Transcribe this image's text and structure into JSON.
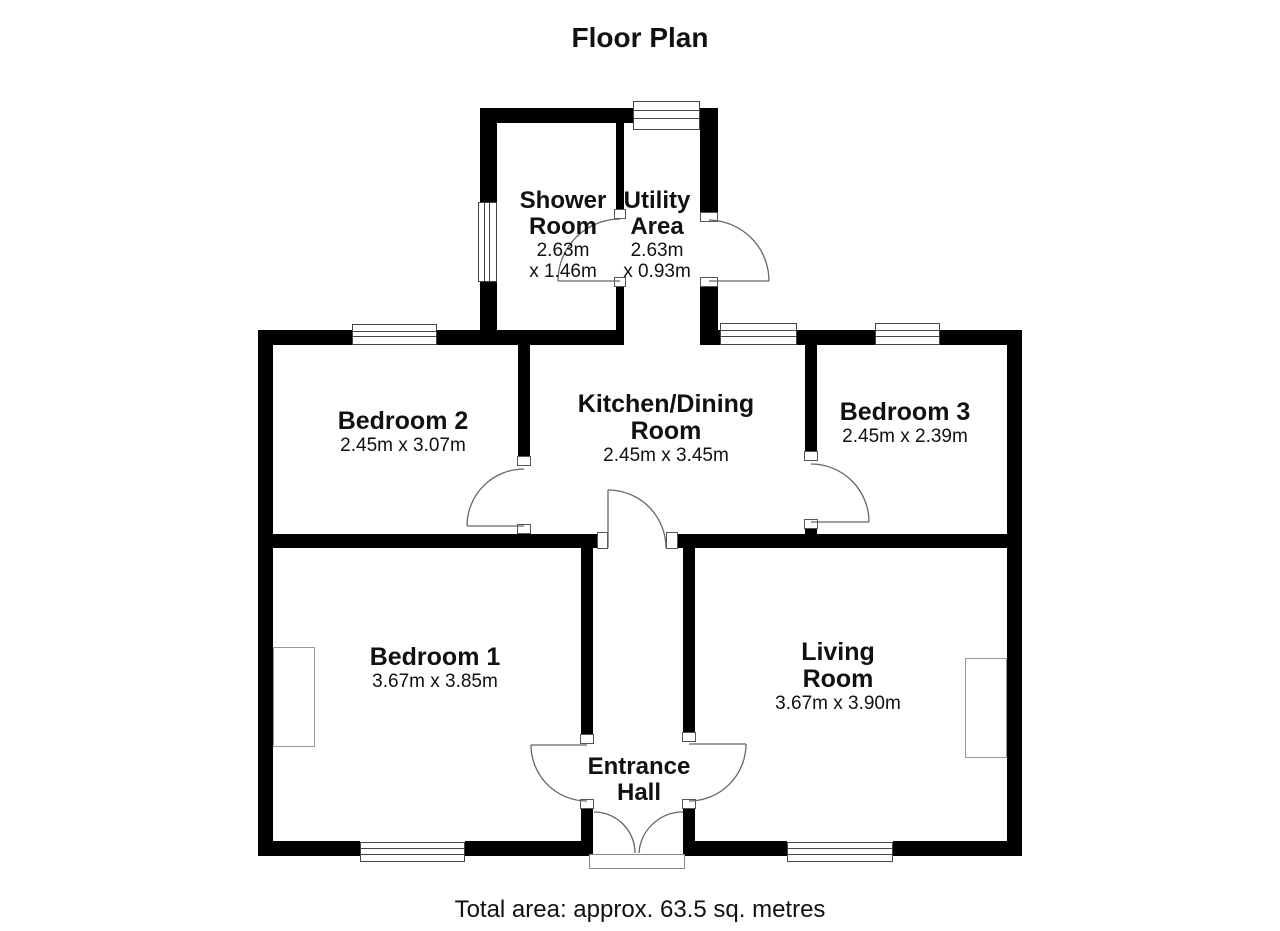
{
  "title": "Floor Plan",
  "footer": "Total area: approx. 63.5 sq. metres",
  "rooms": {
    "shower": {
      "name1": "Shower",
      "name2": "Room",
      "dim1": "2.63m",
      "dim2": "x 1.46m"
    },
    "utility": {
      "name1": "Utility",
      "name2": "Area",
      "dim1": "2.63m",
      "dim2": "x 0.93m"
    },
    "bedroom2": {
      "name1": "Bedroom 2",
      "dim1": "2.45m x 3.07m"
    },
    "kitchen": {
      "name1": "Kitchen/Dining",
      "name2": "Room",
      "dim1": "2.45m x 3.45m"
    },
    "bedroom3": {
      "name1": "Bedroom 3",
      "dim1": "2.45m x 2.39m"
    },
    "bedroom1": {
      "name1": "Bedroom 1",
      "dim1": "3.67m x 3.85m"
    },
    "living": {
      "name1": "Living",
      "name2": "Room",
      "dim1": "3.67m x 3.90m"
    },
    "hall": {
      "name1": "Entrance",
      "name2": "Hall"
    }
  },
  "colors": {
    "wall": "#000000",
    "background": "#ffffff",
    "door_arc": "#666666"
  }
}
